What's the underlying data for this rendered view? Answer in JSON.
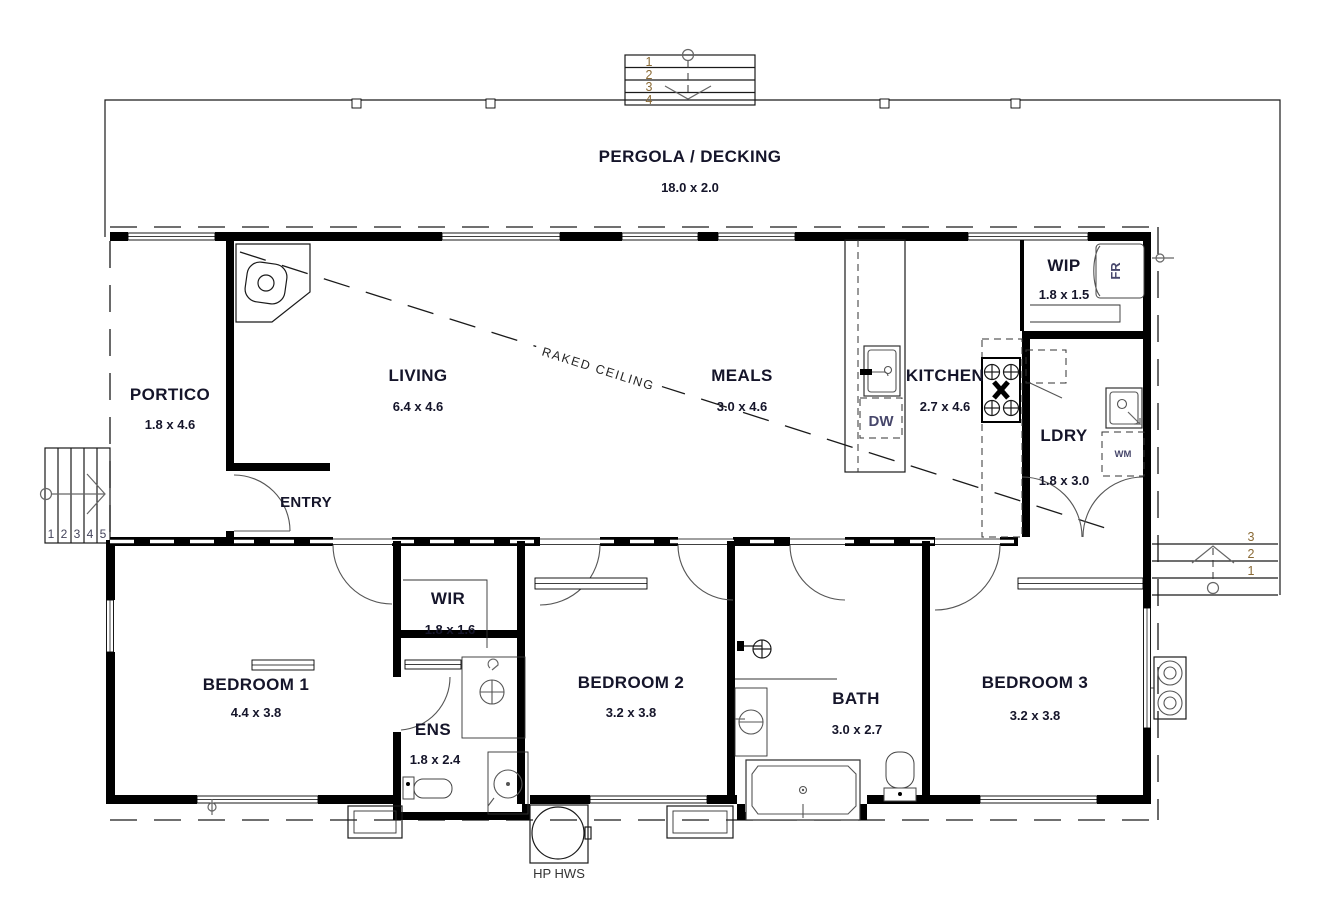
{
  "rooms": {
    "pergola": {
      "name": "PERGOLA / DECKING",
      "dims": "18.0 x 2.0"
    },
    "portico": {
      "name": "PORTICO",
      "dims": "1.8 x 4.6"
    },
    "living": {
      "name": "LIVING",
      "dims": "6.4 x 4.6"
    },
    "meals": {
      "name": "MEALS",
      "dims": "3.0 x 4.6"
    },
    "kitchen": {
      "name": "KITCHEN",
      "dims": "2.7 x 4.6"
    },
    "wip": {
      "name": "WIP",
      "dims": "1.8 x 1.5"
    },
    "ldry": {
      "name": "LDRY",
      "dims": "1.8 x 3.0"
    },
    "entry": {
      "name": "ENTRY"
    },
    "wir": {
      "name": "WIR",
      "dims": "1.8 x 1.6"
    },
    "bedroom1": {
      "name": "BEDROOM 1",
      "dims": "4.4 x 3.8"
    },
    "ens": {
      "name": "ENS",
      "dims": "1.8 x 2.4"
    },
    "bedroom2": {
      "name": "BEDROOM 2",
      "dims": "3.2 x 3.8"
    },
    "bath": {
      "name": "BATH",
      "dims": "3.0 x 2.7"
    },
    "bedroom3": {
      "name": "BEDROOM 3",
      "dims": "3.2 x 3.8"
    }
  },
  "appliances": {
    "fridge": "FR",
    "dishwasher": "DW",
    "washing_machine": "WM",
    "hot_water": "HP HWS"
  },
  "annotations": {
    "raked_ceiling": "RAKED CEILING"
  },
  "stairs": {
    "top": [
      "1",
      "2",
      "3",
      "4"
    ],
    "left": [
      "1",
      "2",
      "3",
      "4",
      "5"
    ],
    "right": [
      "3",
      "2",
      "1"
    ]
  },
  "colors": {
    "wall": "#000000",
    "label": "#15152a",
    "appliance_label": "#47476b",
    "stair_number": "#8a6a35",
    "background": "#ffffff"
  }
}
